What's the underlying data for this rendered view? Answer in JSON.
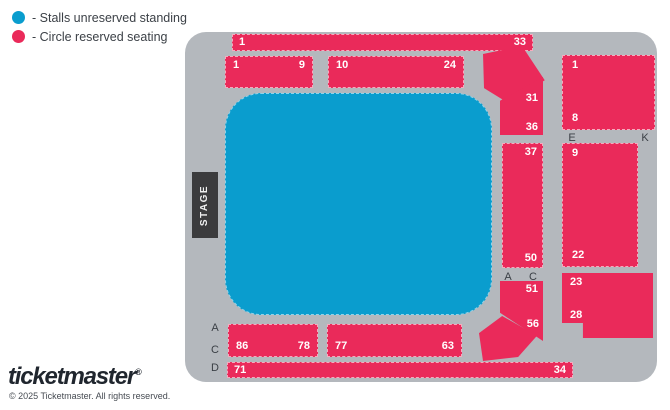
{
  "colors": {
    "stalls": "#0a9dce",
    "circle": "#ea2a5a",
    "panel": "#b4b8bd",
    "stage": "#3b3b3d"
  },
  "legend": {
    "items": [
      {
        "key": "stalls",
        "label": "- Stalls unreserved standing",
        "color": "#0a9dce"
      },
      {
        "key": "circle",
        "label": "- Circle reserved seating",
        "color": "#ea2a5a"
      }
    ]
  },
  "map": {
    "stage_label": "STAGE",
    "blocks": {
      "top_bar": {
        "start": "1",
        "end": "33"
      },
      "left_1_9": {
        "start": "1",
        "end": "9"
      },
      "mid_10_24": {
        "start": "10",
        "end": "24"
      },
      "side_31_36": {
        "start": "31",
        "end": "36"
      },
      "side_37_50": {
        "start": "37",
        "end": "50"
      },
      "side_51_56": {
        "start": "51",
        "end": "56"
      },
      "right_1_8": {
        "start": "1",
        "end": "8"
      },
      "right_9_22": {
        "start": "9",
        "end": "22"
      },
      "right_23_28": {
        "start": "23",
        "end": "28"
      },
      "bottom_86_78": {
        "start": "86",
        "end": "78"
      },
      "bottom_77_63": {
        "start": "77",
        "end": "63"
      },
      "bottom_71_34": {
        "start": "71",
        "end": "34"
      }
    },
    "markers": {
      "mid_a": "A",
      "mid_c": "C",
      "e": "E",
      "k": "K",
      "left_a": "A",
      "left_c": "C",
      "left_d": "D"
    }
  },
  "footer": {
    "logo": "ticketmaster",
    "registered": "®",
    "copyright": "© 2025 Ticketmaster. All rights reserved."
  }
}
